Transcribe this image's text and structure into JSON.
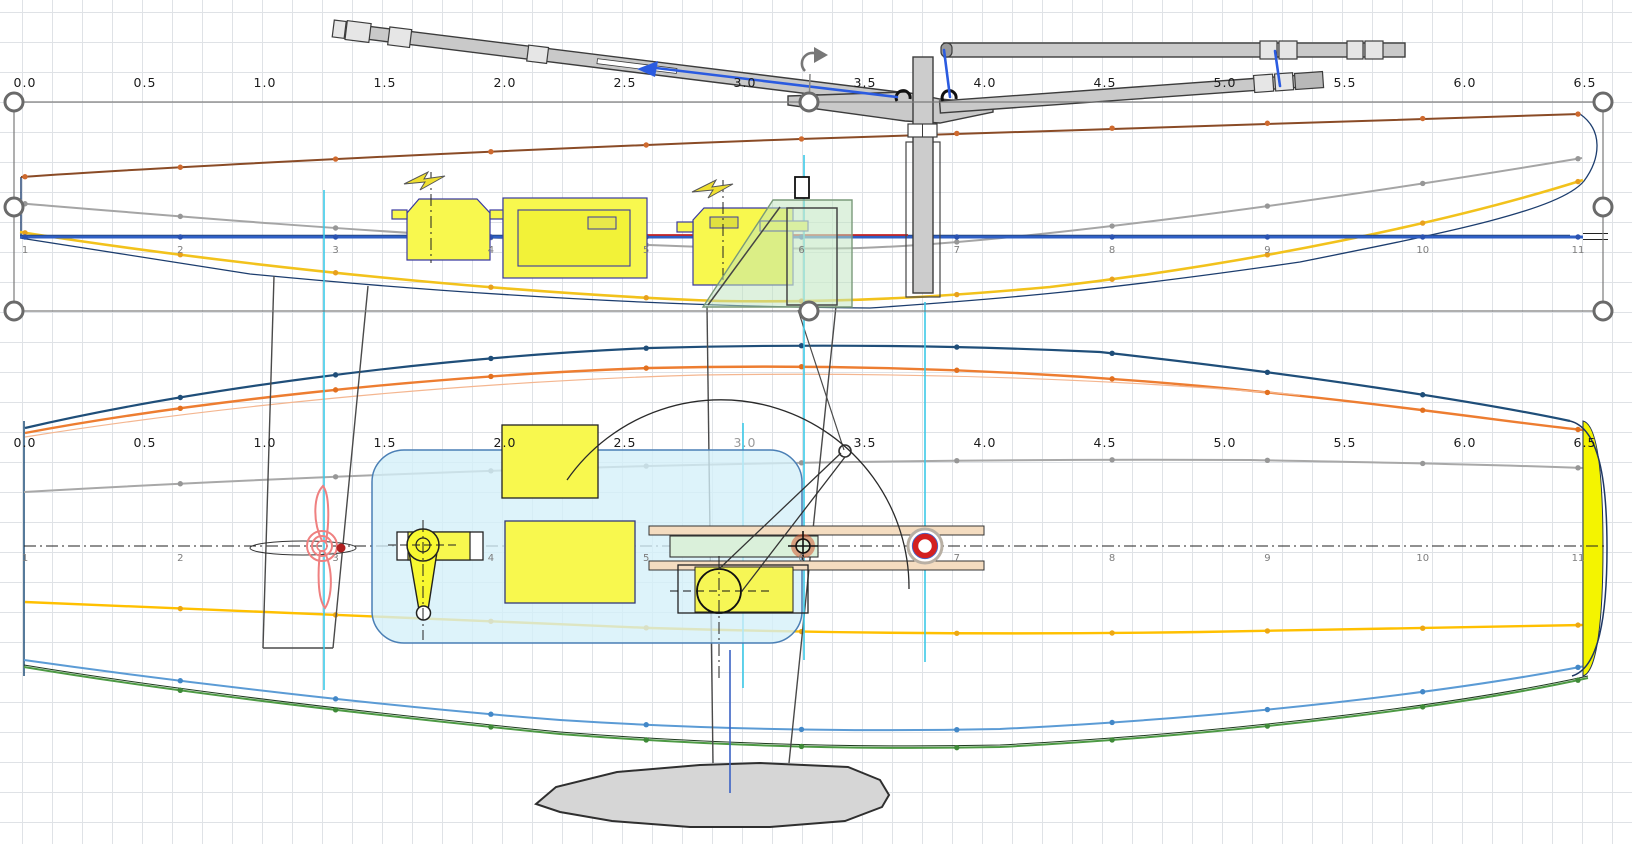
{
  "rulers": {
    "values": [
      "0.0",
      "0.5",
      "1.0",
      "1.5",
      "2.0",
      "2.5",
      "3.0",
      "3.5",
      "4.0",
      "4.5",
      "5.0",
      "5.5",
      "6.0",
      "6.5"
    ],
    "x0": 25,
    "dx": 120,
    "top_y": 87,
    "bottom_y": 447,
    "bottom_muted_index": 6
  },
  "stations": {
    "labels": [
      "1",
      "2",
      "3",
      "4",
      "5",
      "6",
      "7",
      "8",
      "9",
      "10",
      "11"
    ],
    "x0": 25,
    "dx": 155.3,
    "side_y": 253,
    "plan_y": 561
  },
  "icons": [
    "rotation-handle-icon",
    "lightning-bolt-icon",
    "selection-handle-icon",
    "bullseye-icon",
    "crosshair-icon"
  ],
  "colors": {
    "grid": "#dfe2e6",
    "selection_outline": "#7a7a7a",
    "sheer_brown": "#8a4b26",
    "side_gray_line": "#a5a5a5",
    "waterline_blue": "#2f5fc4",
    "hull_outline_navy": "#1c3d6e",
    "keel_yellow": "#f2c21c",
    "red_marker": "#c62222",
    "plan_deck_navy": "#1f4e79",
    "plan_chine_orange": "#ed7d31",
    "plan_gray": "#a8a8a8",
    "plan_waterline_yellow": "#ffc000",
    "plan_diagonal_blue": "#5b9bd5",
    "plan_bottom_green": "#4d9a44",
    "cyan_guides": "#3cc9e8",
    "component_yellow": "#f8f84e",
    "radio_box_fill": "#d8eef8",
    "radio_box_border": "#4a7fb5",
    "fin_green": "#bfe3bd",
    "tan_bar": "#f4dcc0",
    "slide_green": "#daf0da",
    "rig_gray": "#c9c9c9",
    "rig_blue": "#2b5be0",
    "prop_red": "#ef8080",
    "bullseye_red": "#d42020",
    "bulb_gray": "#d6d6d6",
    "bow_yellow": "#f4f400"
  }
}
